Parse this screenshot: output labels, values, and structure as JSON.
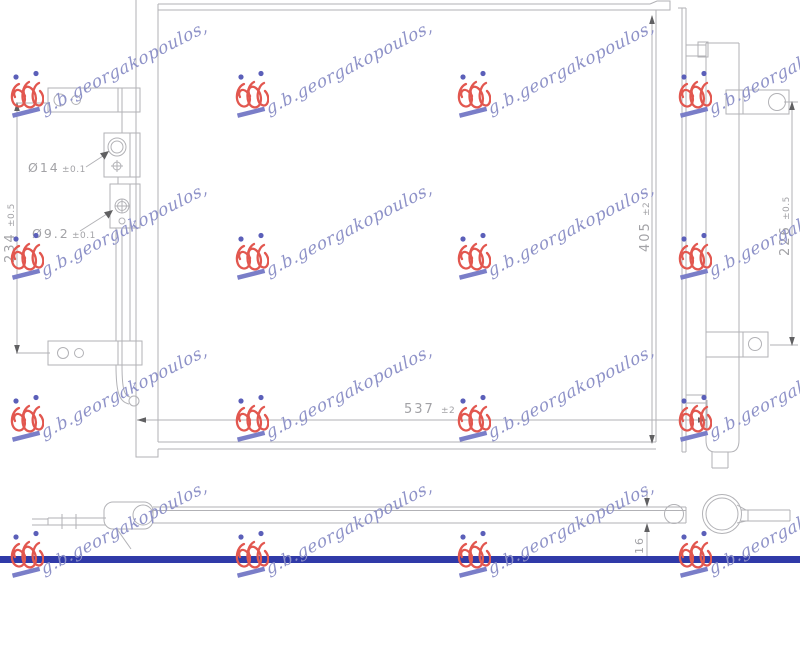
{
  "watermark": {
    "text": "g.b.georgakopoulos,",
    "logo_icon": "gbg-monogram-logo"
  },
  "front_view": {
    "dimensions": {
      "width": {
        "value": "537",
        "tol": "±2"
      },
      "height": {
        "value": "405",
        "tol": "±2"
      },
      "left_span": {
        "value": "234",
        "tol": "±0.5"
      },
      "drier_span": {
        "value": "226",
        "tol": "±0.5"
      },
      "inlet_port": {
        "value": "Ø14",
        "tol": "±0.1"
      },
      "outlet_port": {
        "value": "Ø9.2",
        "tol": "±0.1"
      }
    }
  },
  "side_view": {
    "thickness": "16"
  },
  "colors": {
    "watermark_text": "#8e92c8",
    "logo_red": "#e2574f",
    "logo_dot_blue": "#5b5fb9",
    "logo_underline": "#7a7ec8",
    "drawing_line": "#b2b2b6",
    "dimension_text": "#a2a2a6",
    "arrow": "#606062",
    "footer_bar": "#303aa8"
  }
}
